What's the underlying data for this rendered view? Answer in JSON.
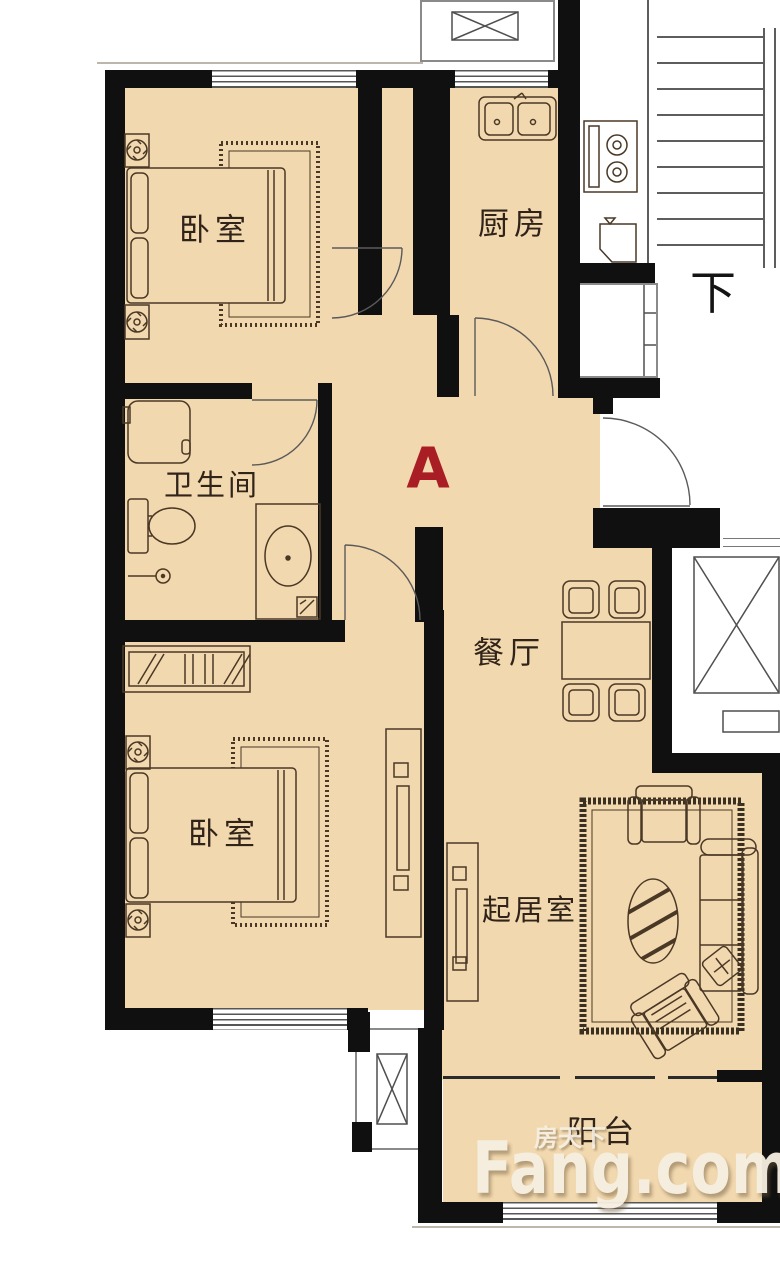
{
  "plan": {
    "unit_label": "A",
    "stair_label": "下",
    "rooms": {
      "bedroom_top": "卧室",
      "kitchen": "厨房",
      "bathroom": "卫生间",
      "bedroom_bottom": "卧室",
      "dining": "餐厅",
      "living": "起居室",
      "balcony": "阳台"
    },
    "watermark": {
      "cn": "房天下",
      "en": "Fang.com"
    },
    "colors": {
      "floor": "#f2d8ae",
      "wall": "#101010",
      "line": "#4a3826",
      "door": "#5a5a5a",
      "accent": "#a81e24",
      "outline": "#8a8a8a",
      "watermark": "#f6efe1"
    }
  }
}
